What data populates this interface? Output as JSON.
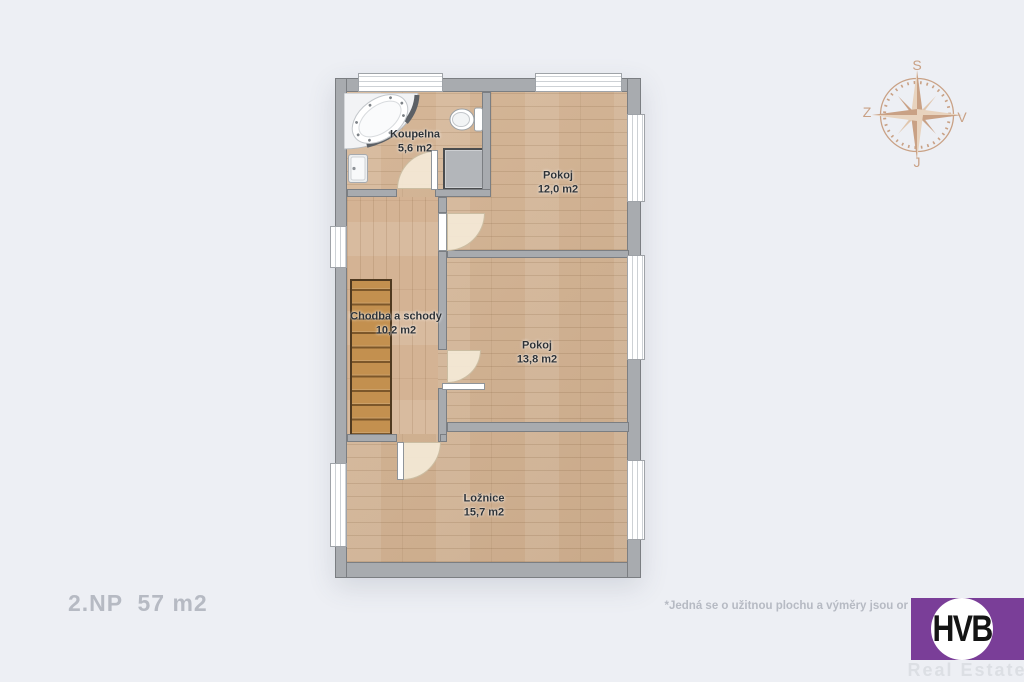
{
  "page": {
    "background_color": "#edeff4",
    "floor_label": "2.NP  57 m2",
    "disclaimer": "*Jedná se o užitnou plochu a výměry jsou or"
  },
  "floor_plan": {
    "rooms": [
      {
        "name": "Koupelna",
        "area": "5,6 m2"
      },
      {
        "name": "Pokoj",
        "area": "12,0 m2"
      },
      {
        "name": "Chodba a schody",
        "area": "10,2 m2"
      },
      {
        "name": "Pokoj",
        "area": "13,8 m2"
      },
      {
        "name": "Ložnice",
        "area": "15,7 m2"
      }
    ],
    "fixture_icons": [
      "bathtub-icon",
      "toilet-icon",
      "sink-icon",
      "staircase",
      "utility-shaft"
    ],
    "wall_color": "#a8abaf",
    "floor_color": "#d2b190",
    "stairs_color": "#c3904f"
  },
  "compass": {
    "top": "S",
    "right": "V",
    "bottom": "J",
    "left": "Z",
    "color": "#c9a185"
  },
  "logo": {
    "monogram": "HVB",
    "subtitle": "Real Estate",
    "brand_color": "#7a3e98"
  }
}
